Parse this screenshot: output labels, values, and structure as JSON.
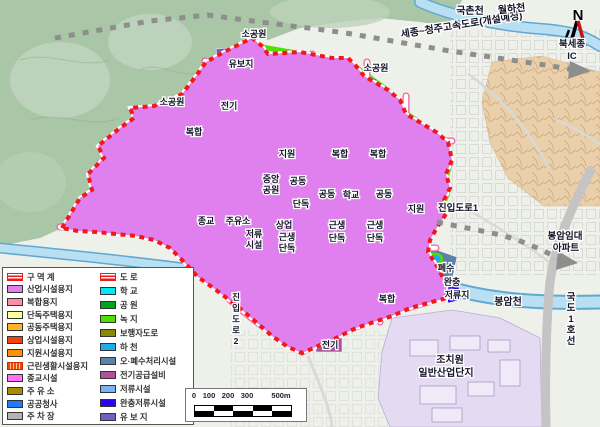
{
  "palette": {
    "industrial": "#e080ef",
    "mixed": "#ff8da6",
    "detached": "#ffff99",
    "apartment": "#ffb428",
    "commercial": "#f5420a",
    "support": "#ff9100",
    "religious": "#ff70ff",
    "gas": "#a98d00",
    "public": "#1e7bff",
    "parking": "#b4b4b4",
    "school": "#00e8f5",
    "park": "#00a51e",
    "green": "#50e000",
    "pedestrian": "#8a8a00",
    "river": "#1badf0",
    "sewage": "#5a82aa",
    "power": "#b0519e",
    "retention": "#7ab4f5",
    "buffer": "#2a06f0",
    "reserved": "#6f5fc8",
    "boundary": "#f21818"
  },
  "north": {
    "label": "N"
  },
  "legend": {
    "left": [
      {
        "label": "구 역 계",
        "pattern": "boundary"
      },
      {
        "label": "산업시설용지",
        "key": "industrial"
      },
      {
        "label": "복합용지",
        "key": "mixed"
      },
      {
        "label": "단독주택용지",
        "key": "detached"
      },
      {
        "label": "공동주택용지",
        "key": "apartment"
      },
      {
        "label": "상업시설용지",
        "key": "commercial"
      },
      {
        "label": "지원시설용지",
        "key": "support"
      },
      {
        "label": "근린생활시설용지",
        "pattern": "hatch"
      },
      {
        "label": "종교시설",
        "key": "religious"
      },
      {
        "label": "주 유 소",
        "key": "gas"
      },
      {
        "label": "공공청사",
        "key": "public"
      },
      {
        "label": "주 차 장",
        "key": "parking"
      }
    ],
    "right": [
      {
        "label": "도    로",
        "pattern": "boundary"
      },
      {
        "label": "학    교",
        "key": "school"
      },
      {
        "label": "공    원",
        "key": "park"
      },
      {
        "label": "녹    지",
        "key": "green"
      },
      {
        "label": "보행자도로",
        "key": "pedestrian"
      },
      {
        "label": "하    천",
        "key": "river"
      },
      {
        "label": "오·폐수처리시설",
        "key": "sewage"
      },
      {
        "label": "전기공급설비",
        "key": "power"
      },
      {
        "label": "저류시설",
        "key": "retention"
      },
      {
        "label": "완충저류시설",
        "key": "buffer"
      },
      {
        "label": "유 보 지",
        "key": "reserved"
      }
    ]
  },
  "scale": {
    "ticks": [
      {
        "t": "0",
        "p": 8
      },
      {
        "t": "100",
        "p": 23
      },
      {
        "t": "200",
        "p": 42
      },
      {
        "t": "300",
        "p": 61
      },
      {
        "t": "500m",
        "p": 95
      }
    ]
  },
  "map_labels": [
    {
      "t": "세종~청주고속도로(개설예정)",
      "x": 462,
      "y": 28,
      "r": -9,
      "s": 10
    },
    {
      "t": "국촌천",
      "x": 470,
      "y": 14,
      "s": 10
    },
    {
      "t": "월하천",
      "x": 512,
      "y": 12,
      "r": -6,
      "s": 10
    },
    {
      "t": "북세종",
      "x": 572,
      "y": 47,
      "s": 9.5
    },
    {
      "t": "IC",
      "x": 572,
      "y": 59,
      "s": 9.5
    },
    {
      "t": "소공원",
      "x": 254,
      "y": 37,
      "s": 9
    },
    {
      "t": "유보지",
      "x": 241,
      "y": 67,
      "s": 9
    },
    {
      "t": "소공원",
      "x": 376,
      "y": 71,
      "s": 9
    },
    {
      "t": "소공원",
      "x": 172,
      "y": 105,
      "s": 9
    },
    {
      "t": "전기",
      "x": 229,
      "y": 109,
      "s": 9
    },
    {
      "t": "복합",
      "x": 194,
      "y": 135,
      "s": 9
    },
    {
      "t": "지원",
      "x": 287,
      "y": 157,
      "s": 9
    },
    {
      "t": "복합",
      "x": 340,
      "y": 157,
      "s": 9
    },
    {
      "t": "복합",
      "x": 378,
      "y": 157,
      "s": 9
    },
    {
      "t": "중앙",
      "x": 271,
      "y": 182,
      "s": 9
    },
    {
      "t": "공원",
      "x": 271,
      "y": 193,
      "s": 9
    },
    {
      "t": "공동",
      "x": 298,
      "y": 184,
      "s": 9
    },
    {
      "t": "단독",
      "x": 301,
      "y": 207,
      "s": 9
    },
    {
      "t": "공동",
      "x": 327,
      "y": 197,
      "s": 9
    },
    {
      "t": "학교",
      "x": 351,
      "y": 198,
      "s": 9
    },
    {
      "t": "공동",
      "x": 384,
      "y": 197,
      "s": 9
    },
    {
      "t": "지원",
      "x": 416,
      "y": 212,
      "s": 9
    },
    {
      "t": "진입도로1",
      "x": 458,
      "y": 211,
      "s": 9.5
    },
    {
      "t": "종교",
      "x": 206,
      "y": 224,
      "s": 9
    },
    {
      "t": "주유소",
      "x": 238,
      "y": 224,
      "s": 9
    },
    {
      "t": "저류",
      "x": 254,
      "y": 237,
      "s": 9
    },
    {
      "t": "시설",
      "x": 254,
      "y": 248,
      "s": 9
    },
    {
      "t": "상업",
      "x": 284,
      "y": 228,
      "s": 9
    },
    {
      "t": "근생",
      "x": 287,
      "y": 240,
      "s": 9
    },
    {
      "t": "단독",
      "x": 287,
      "y": 251,
      "s": 9
    },
    {
      "t": "근생",
      "x": 337,
      "y": 228,
      "s": 9
    },
    {
      "t": "단독",
      "x": 337,
      "y": 241,
      "s": 9
    },
    {
      "t": "근생",
      "x": 375,
      "y": 228,
      "s": 9
    },
    {
      "t": "단독",
      "x": 375,
      "y": 241,
      "s": 9
    },
    {
      "t": "봉암임대",
      "x": 565,
      "y": 239,
      "s": 9.5
    },
    {
      "t": "아파트",
      "x": 566,
      "y": 251,
      "s": 9.5
    },
    {
      "t": "폐수",
      "x": 446,
      "y": 271,
      "s": 9
    },
    {
      "t": "완충",
      "x": 452,
      "y": 285,
      "s": 9
    },
    {
      "t": "저류지",
      "x": 457,
      "y": 298,
      "s": 9
    },
    {
      "t": "복합",
      "x": 387,
      "y": 302,
      "s": 9
    },
    {
      "t": "봉암천",
      "x": 508,
      "y": 305,
      "s": 10
    },
    {
      "t": "전기",
      "x": 330,
      "y": 348,
      "s": 9
    },
    {
      "t": "조치원",
      "x": 450,
      "y": 363,
      "s": 10
    },
    {
      "t": "일반산업단지",
      "x": 446,
      "y": 376,
      "s": 10
    },
    {
      "t": "국도1호선",
      "x": 571,
      "y": 300,
      "s": 9.5,
      "v": true
    },
    {
      "t": "진입도로2",
      "x": 236,
      "y": 300,
      "s": 8.5,
      "v": true
    }
  ]
}
